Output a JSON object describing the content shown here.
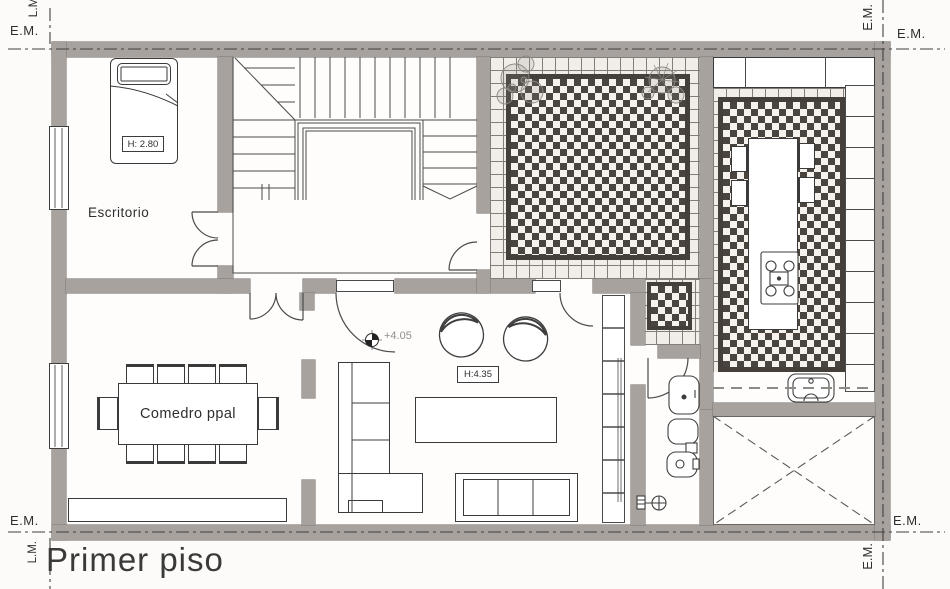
{
  "title": "Primer piso",
  "markers": {
    "property_line": "L.M.",
    "party_wall_axis": "E.M."
  },
  "rooms": {
    "escritorio": {
      "name": "Escritorio",
      "ceiling_height": "H: 2.80"
    },
    "comedor": {
      "name": "Comedro ppal"
    },
    "estar": {
      "ceiling_height": "H:4.35",
      "floor_level": "+4.05"
    }
  },
  "colors": {
    "wall_fill": "#a7a29e",
    "tile_dark": "#4a443e",
    "tile_light": "#f1eee9",
    "drawing_line": "#3e3e3e",
    "paper": "#fcfbf9"
  }
}
